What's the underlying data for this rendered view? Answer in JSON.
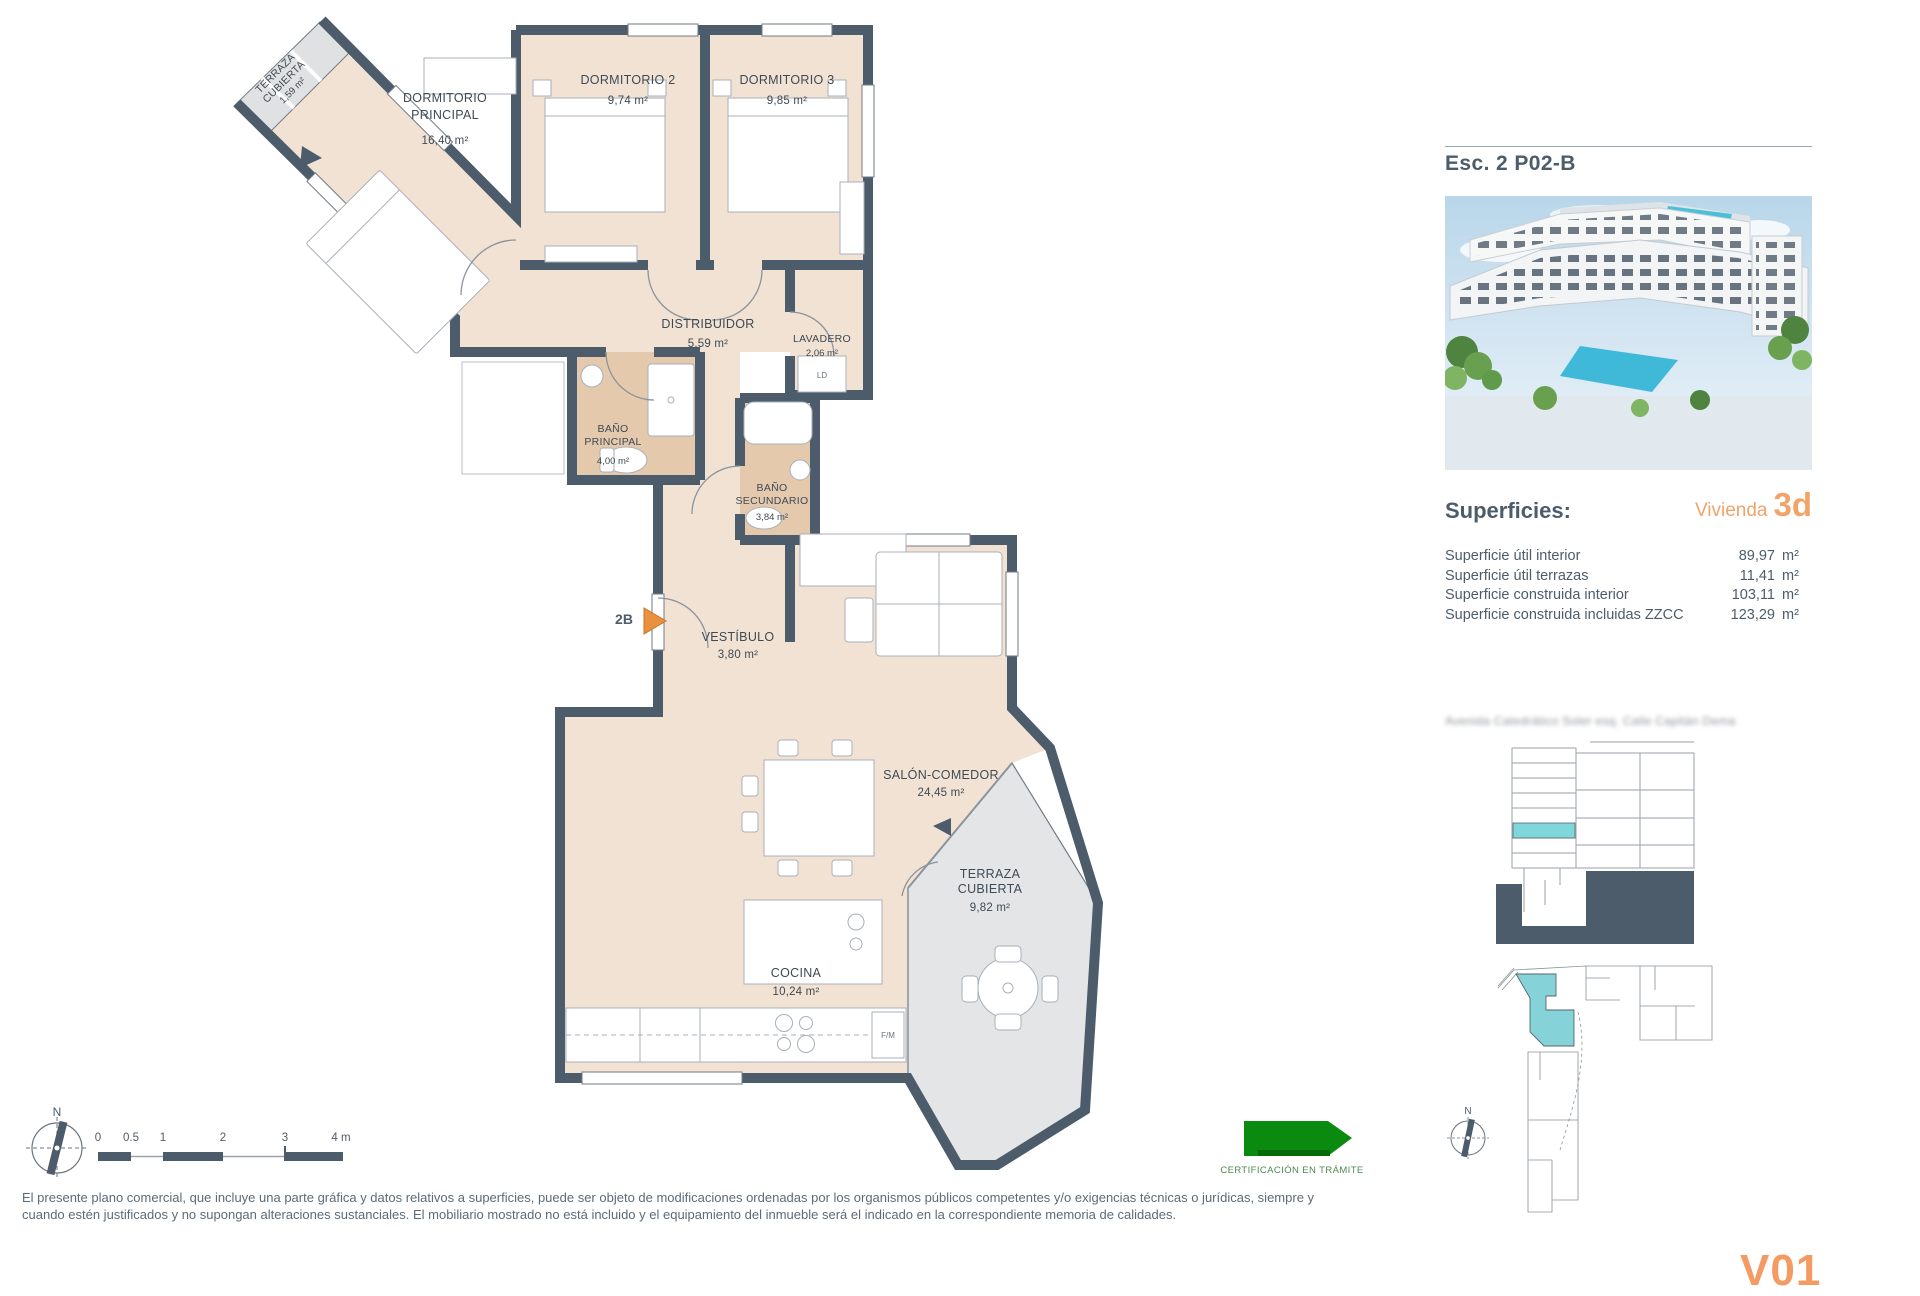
{
  "plan": {
    "north_label": "N",
    "unit_marker": "2B",
    "rooms": {
      "terraza_small": {
        "l1": "TERRAZA",
        "l2": "CUBIERTA",
        "area": "1,59 m²"
      },
      "dormitorio_principal": {
        "l1": "DORMITORIO",
        "l2": "PRINCIPAL",
        "area": "16,40 m²"
      },
      "dormitorio_2": {
        "l1": "DORMITORIO 2",
        "area": "9,74 m²"
      },
      "dormitorio_3": {
        "l1": "DORMITORIO 3",
        "area": "9,85 m²"
      },
      "distribuidor": {
        "l1": "DISTRIBUIDOR",
        "area": "5,59 m²"
      },
      "lavadero": {
        "l1": "LAVADERO",
        "area": "2,06 m²"
      },
      "bano_principal": {
        "l1": "BAÑO",
        "l2": "PRINCIPAL",
        "area": "4,00 m²"
      },
      "bano_secundario": {
        "l1": "BAÑO",
        "l2": "SECUNDARIO",
        "area": "3,84 m²"
      },
      "vestibulo": {
        "l1": "VESTÍBULO",
        "area": "3,80 m²"
      },
      "salon_comedor": {
        "l1": "SALÓN-COMEDOR",
        "area": "24,45 m²"
      },
      "terraza_cubierta": {
        "l1": "TERRAZA",
        "l2": "CUBIERTA",
        "area": "9,82 m²"
      },
      "cocina": {
        "l1": "COCINA",
        "area": "10,24 m²"
      }
    },
    "appliances": {
      "washer": "LD",
      "fridge": "F/M"
    },
    "scale": {
      "t0": "0",
      "t05": "0.5",
      "t1": "1",
      "t2": "2",
      "t3": "3",
      "t4": "4 m"
    }
  },
  "panel": {
    "title": "Esc. 2 P02-B",
    "superficies_heading": "Superficies:",
    "vivienda_label": "Vivienda",
    "vivienda_value": "3d",
    "rows": [
      {
        "label": "Superficie útil interior",
        "value": "89,97",
        "unit": "m²"
      },
      {
        "label": "Superficie útil terrazas",
        "value": "11,41",
        "unit": "m²"
      },
      {
        "label": "Superficie construida interior",
        "value": "103,11",
        "unit": "m²"
      },
      {
        "label": "Superficie construida incluidas ZZCC",
        "value": "123,29",
        "unit": "m²"
      }
    ],
    "address": "Avenida Catedrático Soler esq. Calle Capitán Dema",
    "north_label": "N"
  },
  "footer": {
    "disclaimer_line1": "El presente plano comercial, que incluye una parte gráfica y datos relativos a superficies, puede ser objeto de modificaciones ordenadas por los organismos públicos competentes y/o exigencias técnicas o jurídicas, siempre y",
    "disclaimer_line2": "cuando estén justificados y no supongan alteraciones sustanciales. El mobiliario mostrado no está incluido y el equipamiento del inmueble será el indicado en la correspondiente memoria de calidades.",
    "certification": "CERTIFICACIÓN EN TRÁMITE",
    "version": "V01"
  },
  "colors": {
    "wall": "#4d5c6b",
    "floor": "#f2e2d4",
    "wet_floor": "#e5c9ac",
    "terrace": "#e4e5e6",
    "accent_orange": "#f2a369",
    "highlight_teal": "#85d2d8",
    "cert_green": "#0b8a10"
  }
}
